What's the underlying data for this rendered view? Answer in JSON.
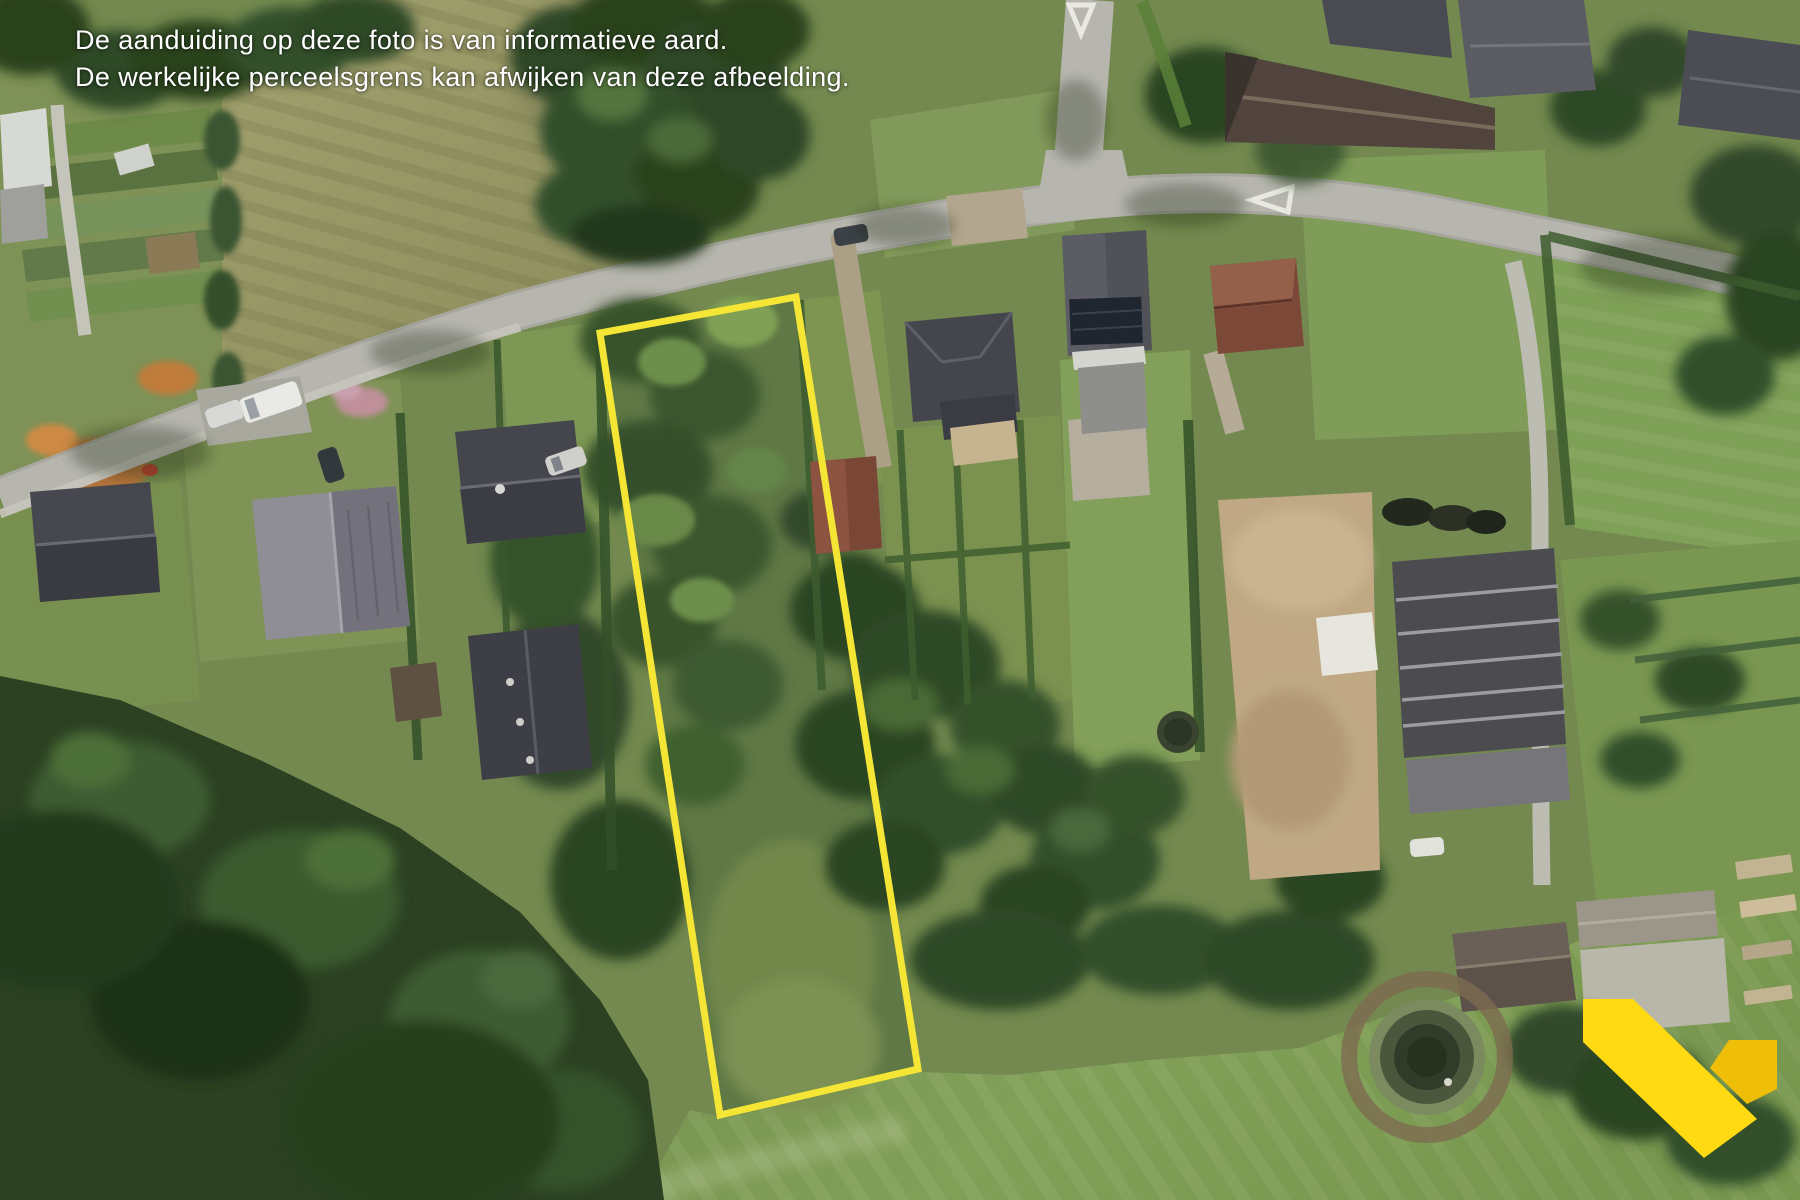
{
  "disclaimer": {
    "line1": "De aanduiding op deze foto is van informatieve aard.",
    "line2": "De werkelijke perceelsgrens kan afwijken van deze afbeelding.",
    "text_color": "#ffffff"
  },
  "parcel": {
    "outline_points": "600,333 796,297 918,1069 720,1115",
    "outline_color": "#F5E636",
    "outline_width": "7"
  },
  "logo": {
    "name": "yellow-check-v-logo",
    "primary_color": "#FFD912",
    "secondary_color": "#EFBE08",
    "main_points": "1583,999 1633,999 1757,1119 1704,1158 1583,1042",
    "accent_points": "1729,1040 1777,1040 1777,1089 1747,1104 1710,1068"
  },
  "palette": {
    "base_green": "#73894f",
    "road_gray": "#b7b6ae",
    "olive_field": "#98986a",
    "meadow_green": "#7d9b55",
    "parcel_interior": "#5f7845",
    "dark_trees": "#2b4122",
    "marking_white": "#e9e9e2"
  }
}
